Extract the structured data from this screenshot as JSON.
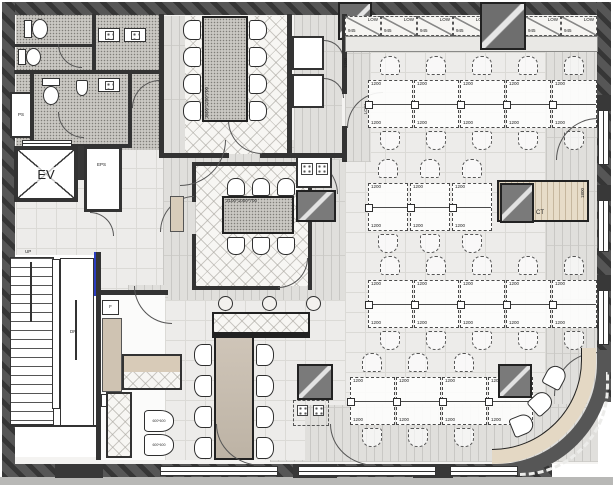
{
  "floorplan": {
    "colors": {
      "wall": "#565656",
      "line": "#333333",
      "wood_counter": "#e4d8c4",
      "floor_tile": "#edecea",
      "meeting_floor": "#f7f6f3",
      "accent_blue": "#2a3cc0"
    },
    "core": {
      "elevator": "EV",
      "eps": "EPS",
      "pipe_shaft": "PS",
      "stairs_up": "UP",
      "stairs_down": "DN"
    },
    "office": {
      "cabinets": [
        {
          "label": "LOW",
          "dim": "945"
        },
        {
          "label": "LOW",
          "dim": "945"
        },
        {
          "label": "LOW",
          "dim": "945"
        },
        {
          "label": "LOW",
          "dim": "945"
        },
        {
          "label": "LOW",
          "dim": "945"
        },
        {
          "label": "LOW",
          "dim": "945"
        },
        {
          "label": "LOW",
          "dim": "945"
        }
      ],
      "desk_label": "1200",
      "side_low_label": "LOW",
      "side_desk_dim": "1200",
      "counter_label": "CT",
      "counter_dim": "1800"
    },
    "conference_room": {
      "table_dim": "3600*1200*700"
    },
    "meeting_room": {
      "table_dim": "2100*1000*700"
    },
    "cafe": {
      "fridge_label": "F",
      "pipe_shaft": "PS",
      "chair_dim": "600*600"
    }
  }
}
